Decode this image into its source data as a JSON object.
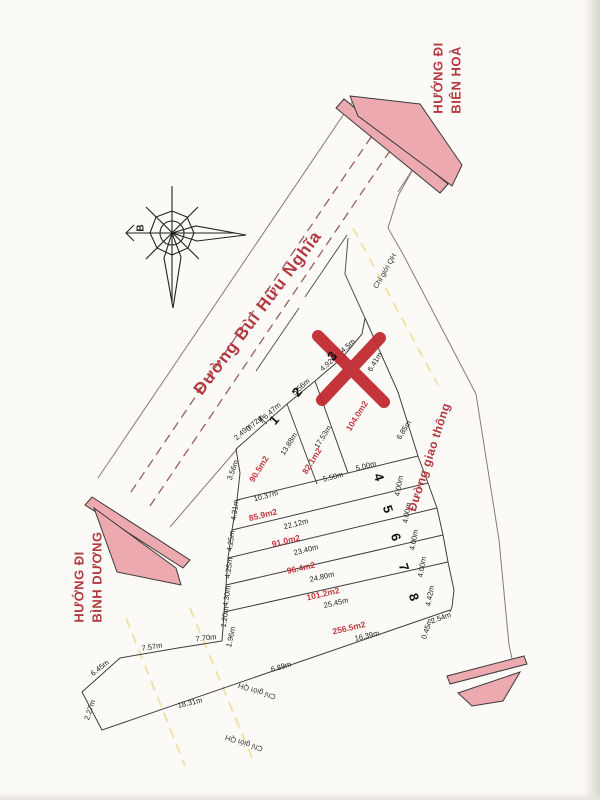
{
  "colors": {
    "accent_red": "#b2393f",
    "area_red": "#c03a3c",
    "pink_fill": "#ecaab0",
    "qh_yellow": "#e3d069",
    "x_mark_red": "#c02b30"
  },
  "compass": {
    "north_label": "B"
  },
  "roads": {
    "main": "Đường Bùi Hữu Nghĩa",
    "secondary": "Đường giao thông"
  },
  "directions": {
    "bien_hoa": [
      "HƯỚNG ĐI",
      "BIÊN HOÀ"
    ],
    "binh_duong": [
      "HƯỚNG ĐI",
      "BÌNH DƯƠNG"
    ]
  },
  "boundary_label": "Chỉ giới QH",
  "lots": [
    {
      "number": "1",
      "area": "90.5m2"
    },
    {
      "number": "2",
      "area": "82.1m2"
    },
    {
      "number": "3",
      "area": "104.0m2",
      "note": "marked with red X"
    },
    {
      "number": "4",
      "area": "85.9m2"
    },
    {
      "number": "5",
      "area": "91.0m2"
    },
    {
      "number": "6",
      "area": "96.4m2"
    },
    {
      "number": "7",
      "area": "101.2m2"
    },
    {
      "number": "8",
      "area": "256.5m2"
    }
  ],
  "labels": [
    {
      "t": "2.49m",
      "x": 243,
      "y": 432,
      "r": -42,
      "c": "dim"
    },
    {
      "t": "0.72m",
      "x": 255,
      "y": 423,
      "r": -42,
      "c": "dim"
    },
    {
      "t": "6.47m",
      "x": 272,
      "y": 411,
      "r": -42,
      "c": "dim"
    },
    {
      "t": "5.56m",
      "x": 301,
      "y": 387,
      "r": -42,
      "c": "dim"
    },
    {
      "t": "4.92m",
      "x": 329,
      "y": 363,
      "r": -42,
      "c": "dim"
    },
    {
      "t": "4.5m",
      "x": 348,
      "y": 346,
      "r": -42,
      "c": "dim"
    },
    {
      "t": "3.56m",
      "x": 233,
      "y": 470,
      "r": -70,
      "c": "dim"
    },
    {
      "t": "13.88m",
      "x": 289,
      "y": 444,
      "r": -58,
      "c": "dim"
    },
    {
      "t": "17.53m",
      "x": 323,
      "y": 437,
      "r": -58,
      "c": "dim"
    },
    {
      "t": "6.41m",
      "x": 375,
      "y": 362,
      "r": -58,
      "c": "dim"
    },
    {
      "t": "6.85m",
      "x": 404,
      "y": 430,
      "r": -58,
      "c": "dim"
    },
    {
      "t": "5.50m",
      "x": 333,
      "y": 477,
      "r": -14,
      "c": "dim"
    },
    {
      "t": "5.00m",
      "x": 366,
      "y": 466,
      "r": -14,
      "c": "dim"
    },
    {
      "t": "10.37m",
      "x": 266,
      "y": 496,
      "r": -15,
      "c": "dim"
    },
    {
      "t": "22.12m",
      "x": 296,
      "y": 524,
      "r": -14,
      "c": "dim"
    },
    {
      "t": "23.40m",
      "x": 306,
      "y": 550,
      "r": -14,
      "c": "dim"
    },
    {
      "t": "24.80m",
      "x": 322,
      "y": 577,
      "r": -13,
      "c": "dim"
    },
    {
      "t": "25.45m",
      "x": 336,
      "y": 603,
      "r": -13,
      "c": "dim"
    },
    {
      "t": "16.39m",
      "x": 367,
      "y": 636,
      "r": -13,
      "c": "dim"
    },
    {
      "t": "6.89m",
      "x": 281,
      "y": 667,
      "r": -16,
      "c": "dim"
    },
    {
      "t": "18.31m",
      "x": 190,
      "y": 703,
      "r": -13,
      "c": "dim"
    },
    {
      "t": "7.57m",
      "x": 152,
      "y": 647,
      "r": -10,
      "c": "dim"
    },
    {
      "t": "7.70m",
      "x": 206,
      "y": 638,
      "r": -6,
      "c": "dim"
    },
    {
      "t": "6.45m",
      "x": 100,
      "y": 668,
      "r": -38,
      "c": "dim"
    },
    {
      "t": "2.27m",
      "x": 90,
      "y": 710,
      "r": -72,
      "c": "dim"
    },
    {
      "t": "4.31m",
      "x": 235,
      "y": 510,
      "r": -82,
      "c": "dim"
    },
    {
      "t": "4.25m",
      "x": 231,
      "y": 541,
      "r": -82,
      "c": "dim"
    },
    {
      "t": "4.25m",
      "x": 229,
      "y": 568,
      "r": -82,
      "c": "dim"
    },
    {
      "t": "4.30m",
      "x": 227,
      "y": 596,
      "r": -82,
      "c": "dim"
    },
    {
      "t": "1.20m",
      "x": 225,
      "y": 617,
      "r": -82,
      "c": "dim"
    },
    {
      "t": "1.96m",
      "x": 231,
      "y": 637,
      "r": -78,
      "c": "dim"
    },
    {
      "t": "4.00m",
      "x": 399,
      "y": 486,
      "r": -80,
      "c": "dim"
    },
    {
      "t": "4.00m",
      "x": 407,
      "y": 513,
      "r": -80,
      "c": "dim"
    },
    {
      "t": "4.00m",
      "x": 414,
      "y": 540,
      "r": -80,
      "c": "dim"
    },
    {
      "t": "4.00m",
      "x": 422,
      "y": 567,
      "r": -80,
      "c": "dim"
    },
    {
      "t": "4.42m",
      "x": 430,
      "y": 596,
      "r": -80,
      "c": "dim"
    },
    {
      "t": "0.45m",
      "x": 427,
      "y": 629,
      "r": -72,
      "c": "dim"
    },
    {
      "t": "2.54m",
      "x": 441,
      "y": 618,
      "r": -20,
      "c": "dim"
    },
    {
      "t": "90.5m2",
      "x": 259,
      "y": 469,
      "r": -58,
      "c": "area"
    },
    {
      "t": "82.1m2",
      "x": 312,
      "y": 461,
      "r": -58,
      "c": "area"
    },
    {
      "t": "104.0m2",
      "x": 357,
      "y": 416,
      "r": -58,
      "c": "area"
    },
    {
      "t": "85.9m2",
      "x": 263,
      "y": 515,
      "r": -14,
      "c": "area"
    },
    {
      "t": "91.0m2",
      "x": 286,
      "y": 541,
      "r": -14,
      "c": "area"
    },
    {
      "t": "96.4m2",
      "x": 301,
      "y": 568,
      "r": -13,
      "c": "area"
    },
    {
      "t": "101.2m2",
      "x": 323,
      "y": 594,
      "r": -13,
      "c": "area"
    },
    {
      "t": "256.5m2",
      "x": 349,
      "y": 628,
      "r": -13,
      "c": "area"
    },
    {
      "t": "1",
      "x": 274,
      "y": 420,
      "r": -50,
      "c": "num"
    },
    {
      "t": "2",
      "x": 297,
      "y": 392,
      "r": -50,
      "c": "num"
    },
    {
      "t": "3",
      "x": 332,
      "y": 356,
      "r": -50,
      "c": "num"
    },
    {
      "t": "4",
      "x": 379,
      "y": 477,
      "r": 72,
      "c": "num"
    },
    {
      "t": "5",
      "x": 388,
      "y": 509,
      "r": 72,
      "c": "num"
    },
    {
      "t": "6",
      "x": 396,
      "y": 537,
      "r": 72,
      "c": "num"
    },
    {
      "t": "7",
      "x": 404,
      "y": 567,
      "r": 72,
      "c": "num"
    },
    {
      "t": "8",
      "x": 414,
      "y": 597,
      "r": 72,
      "c": "num"
    },
    {
      "t": "Chỉ giới QH",
      "x": 385,
      "y": 271,
      "r": -60,
      "c": "qh"
    },
    {
      "t": "Chỉ giới QH",
      "x": 257,
      "y": 691,
      "r": 198,
      "c": "qh"
    },
    {
      "t": "Chỉ giới QH",
      "x": 244,
      "y": 743,
      "r": 198,
      "c": "qh"
    }
  ]
}
